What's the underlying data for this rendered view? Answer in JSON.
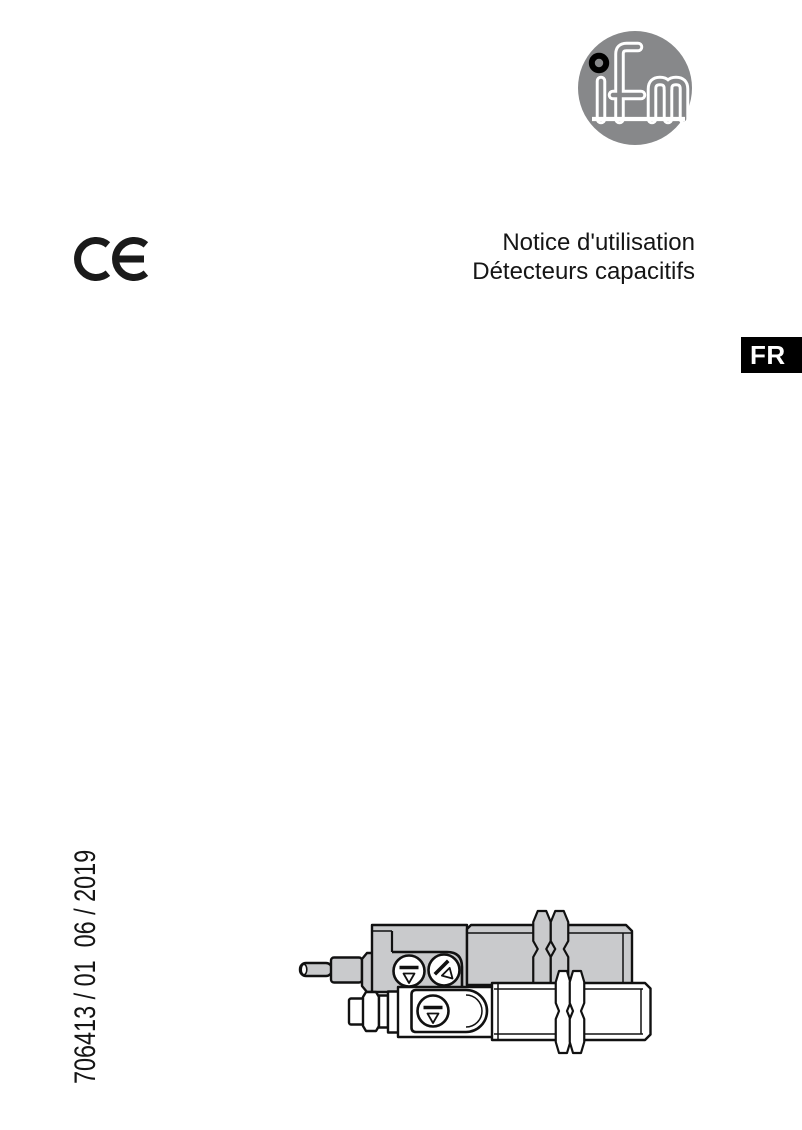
{
  "page": {
    "background": "#ffffff",
    "width": 802,
    "height": 1130
  },
  "branding": {
    "logo_text": "ifm",
    "logo_circle_color": "#87888a",
    "logo_letter_color": "#ffffff",
    "logo_dot_color": "#000000"
  },
  "certification": {
    "mark": "CE"
  },
  "title": {
    "line1": "Notice d'utilisation",
    "line2": "Détecteurs capacitifs"
  },
  "language_badge": {
    "label": "FR",
    "background": "#000000",
    "color": "#ffffff"
  },
  "document_number": "706413 / 01  06 / 2019",
  "illustration": {
    "name": "capacitive-sensors-drawing",
    "sensor_body_color": "#c9cacc",
    "outline_color": "#111111",
    "parts": [
      "cable-sensor-with-two-adjustment-screws",
      "connector-sensor-with-one-adjustment-screw"
    ]
  }
}
